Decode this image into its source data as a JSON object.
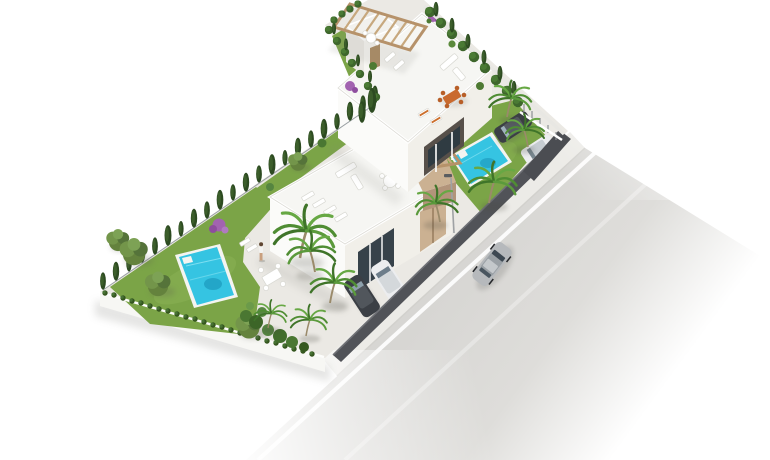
{
  "scene": {
    "label": "aerial-3d-render-two-villas-with-pools-and-road",
    "palette": {
      "background": "#ffffff",
      "pavement": "#ebe9e4",
      "plinth": "#f7f7f4",
      "deck": "#f6f6f3",
      "wall_white": "#fbfbf9",
      "wall_shaded": "#f1efe9",
      "lawn": "#7ba447",
      "cypress": "#2d4b21",
      "hedge": "#3e662c",
      "olive": "#64823d",
      "palm": "#4f8d33",
      "pool_rim": "#f4f4f1",
      "pool_water": "#35c4e2",
      "pool_deep": "#1a96ba",
      "pergola_wood": "#c3a27c",
      "beige_wall": "#cbb192",
      "dark_wall": "#515358",
      "road": "#d7d6d3",
      "sidewalk": "#ecebe7",
      "lane_line": "#ffffff",
      "car_dark": "#3b3f45",
      "car_silver": "#b6b9bc",
      "car_white": "#ecedef",
      "orange_furniture": "#c96a2e",
      "purple_flowers": "#a263b0",
      "wood_door": "#ab8a61",
      "glazing": "#37424a"
    },
    "inventory": {
      "villas": 2,
      "roof_terraces": 2,
      "pergolas": 2,
      "swimming_pools": 2,
      "parked_cars": 4,
      "cars_on_road": 1,
      "people": 1,
      "street_lamps": 1
    }
  }
}
